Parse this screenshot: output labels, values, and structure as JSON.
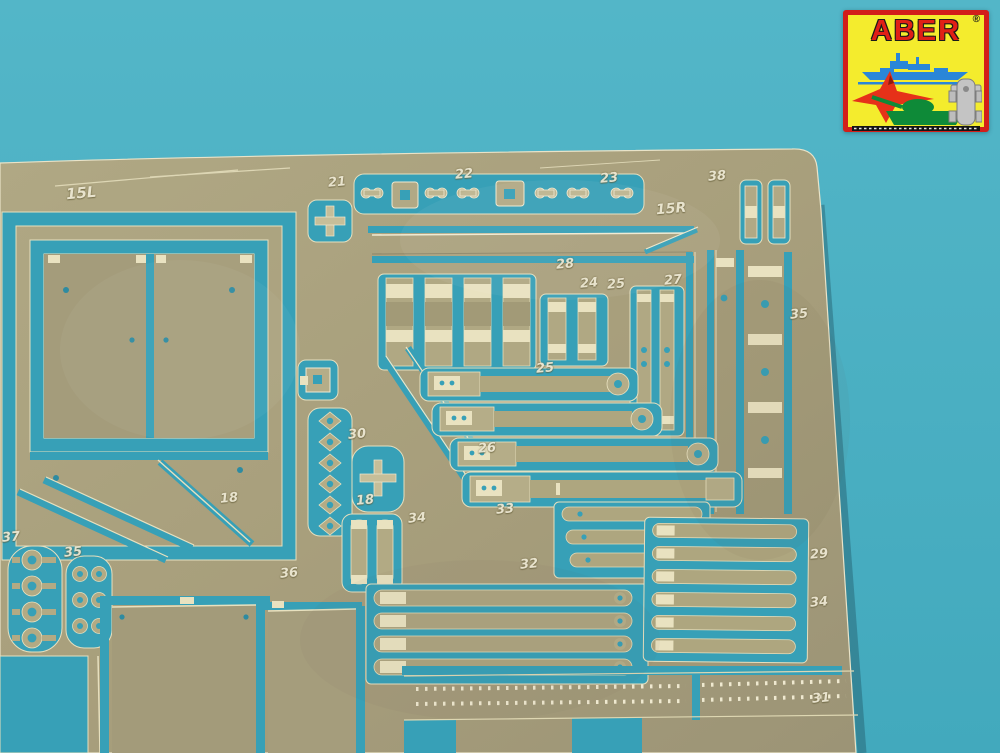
{
  "colors": {
    "background_teal": "#4bb0c3",
    "cutout_blue": "#37a0b7",
    "brass": "#a89f7c",
    "etch_highlight": "#efe9d0",
    "stamp_text": "#ece7d2",
    "logo_yellow": "#f4ec2d",
    "logo_border_red": "#d21e1a",
    "logo_text_red": "#e02016",
    "ship_blue": "#2a86d8",
    "jet_red": "#e63119",
    "tank_green": "#0e8a38",
    "car_gray": "#c4c4c4",
    "track_black": "#151515"
  },
  "logo": {
    "brand": "ABER",
    "registered": "®"
  },
  "fret": {
    "part_labels": [
      {
        "text": "15L",
        "x": 66,
        "y": 186,
        "size": 15
      },
      {
        "text": "21",
        "x": 328,
        "y": 176
      },
      {
        "text": "22",
        "x": 455,
        "y": 168
      },
      {
        "text": "23",
        "x": 600,
        "y": 172
      },
      {
        "text": "38",
        "x": 708,
        "y": 170
      },
      {
        "text": "15R",
        "x": 656,
        "y": 202,
        "size": 14
      },
      {
        "text": "28",
        "x": 556,
        "y": 258
      },
      {
        "text": "24",
        "x": 580,
        "y": 277
      },
      {
        "text": "25",
        "x": 607,
        "y": 278
      },
      {
        "text": "27",
        "x": 664,
        "y": 274
      },
      {
        "text": "35",
        "x": 790,
        "y": 308
      },
      {
        "text": "25",
        "x": 536,
        "y": 362
      },
      {
        "text": "30",
        "x": 348,
        "y": 428
      },
      {
        "text": "26",
        "x": 478,
        "y": 442
      },
      {
        "text": "18",
        "x": 220,
        "y": 492
      },
      {
        "text": "18",
        "x": 356,
        "y": 494
      },
      {
        "text": "34",
        "x": 408,
        "y": 512
      },
      {
        "text": "33",
        "x": 496,
        "y": 503
      },
      {
        "text": "32",
        "x": 520,
        "y": 558
      },
      {
        "text": "37",
        "x": 2,
        "y": 531
      },
      {
        "text": "35",
        "x": 64,
        "y": 546
      },
      {
        "text": "36",
        "x": 280,
        "y": 567
      },
      {
        "text": "29",
        "x": 810,
        "y": 548
      },
      {
        "text": "34",
        "x": 810,
        "y": 596
      },
      {
        "text": "31",
        "x": 812,
        "y": 692
      }
    ]
  }
}
